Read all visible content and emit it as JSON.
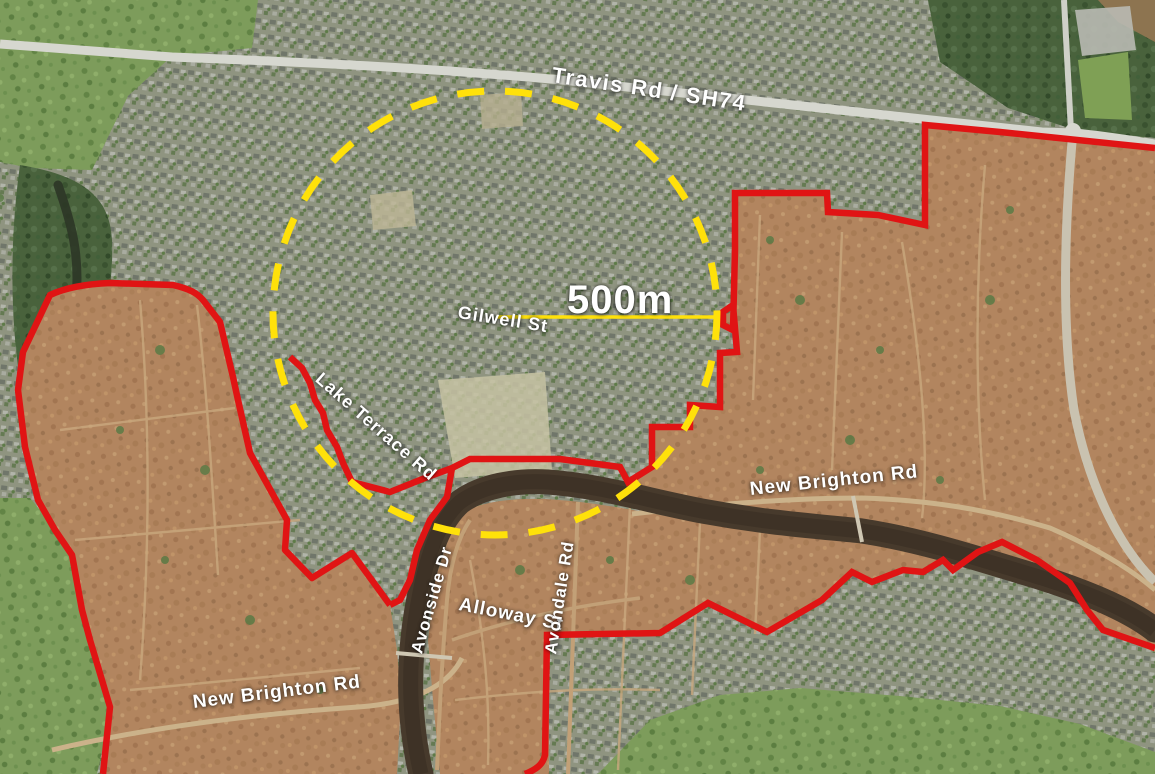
{
  "figure": {
    "description": "Aerial photo map with residential red zone boundaries and a 500 m radius circle",
    "scale_circle": {
      "label": "500m"
    },
    "road_labels": {
      "travis_rd_sh74": "Travis Rd / SH74",
      "gilwell_st": "Gilwell St",
      "lake_terrace_rd": "Lake Terrace Rd",
      "new_brighton_rd_east": "New Brighton Rd",
      "new_brighton_rd_west": "New Brighton Rd",
      "avonside_dr": "Avonside Dr",
      "alloway_st": "Alloway St",
      "avondale_rd": "Avondale Rd"
    },
    "colors": {
      "red_zone_boundary": "#e01414",
      "radius_circle_yellow": "#ffe10a",
      "label_text": "#ffffff"
    }
  }
}
